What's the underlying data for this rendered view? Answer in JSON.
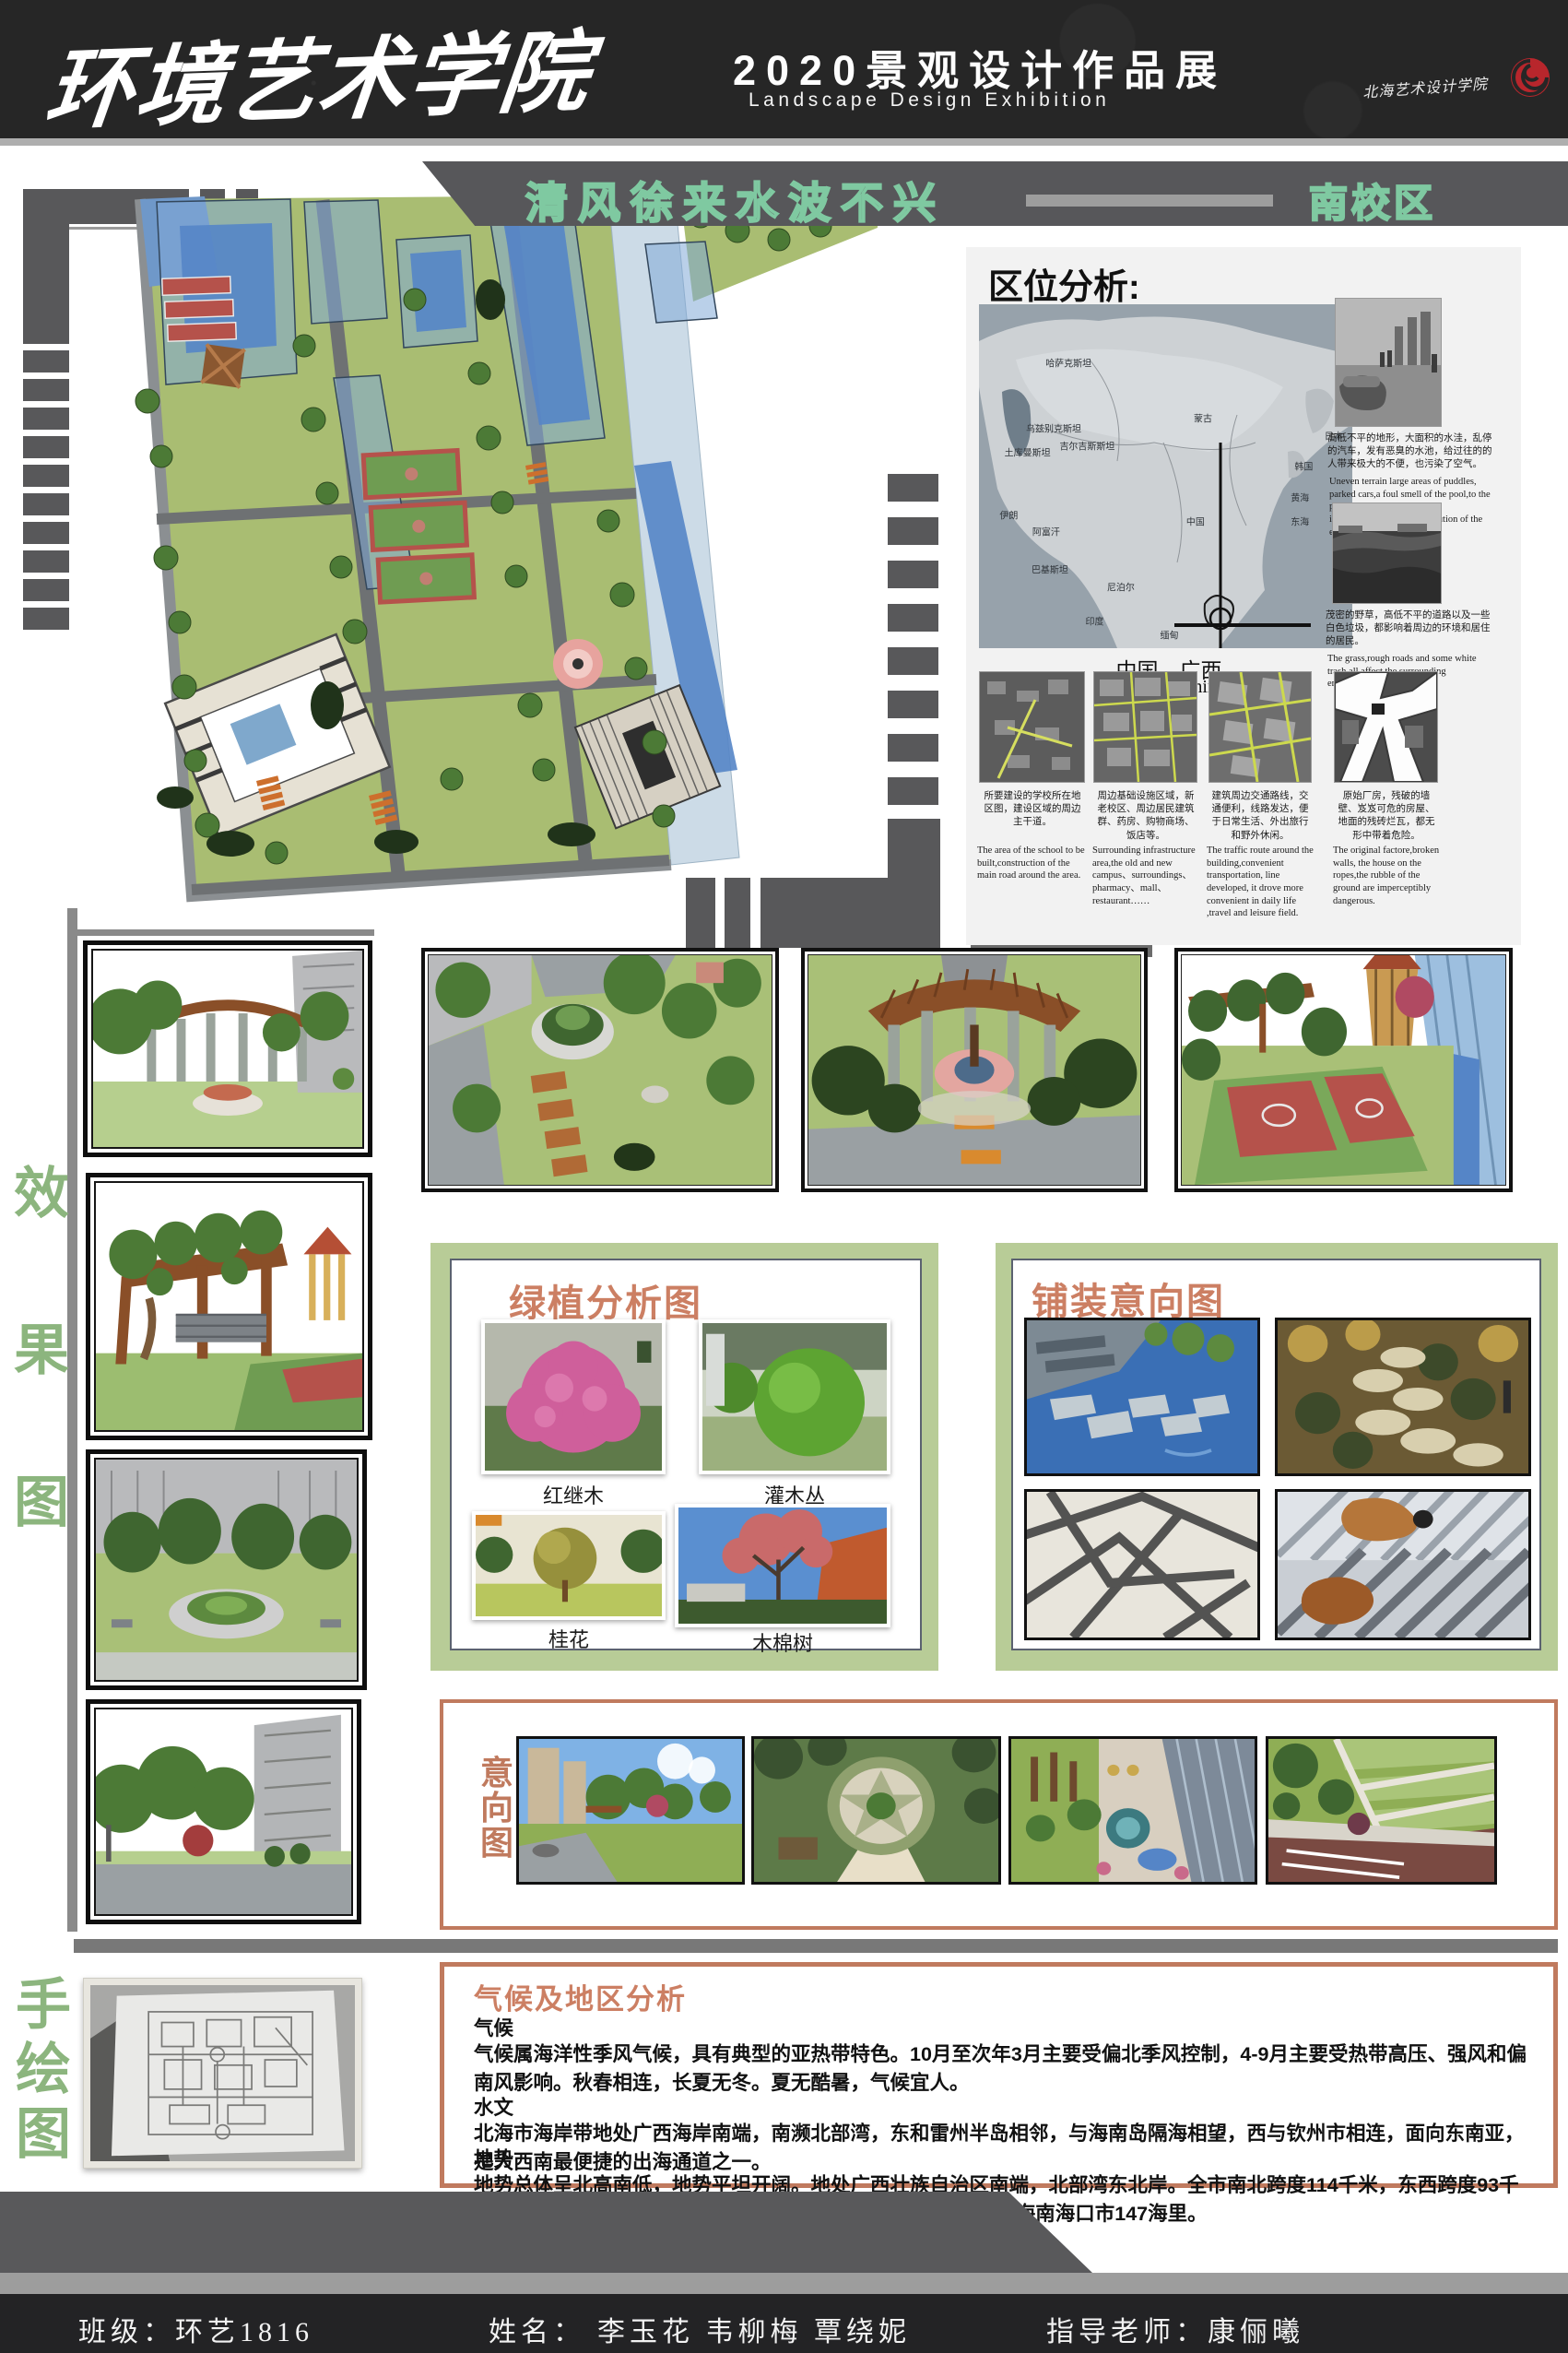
{
  "header": {
    "school": "环境艺术学院",
    "title": "2020景观设计作品展",
    "subtitle": "Landscape Design Exhibition",
    "logo_text": "北海艺术设计学院"
  },
  "banner": {
    "slogan": "清风徐来水波不兴",
    "campus": "南校区"
  },
  "location": {
    "title": "区位分析:",
    "map_labels": [
      {
        "t": "哈萨克斯坦",
        "x": 24,
        "y": 17
      },
      {
        "t": "乌兹别克斯坦",
        "x": 20,
        "y": 36
      },
      {
        "t": "土库曼斯坦",
        "x": 13,
        "y": 43
      },
      {
        "t": "吉尔吉斯斯坦",
        "x": 29,
        "y": 41
      },
      {
        "t": "蒙古",
        "x": 60,
        "y": 33
      },
      {
        "t": "伊朗",
        "x": 8,
        "y": 61
      },
      {
        "t": "阿富汗",
        "x": 18,
        "y": 66
      },
      {
        "t": "中国",
        "x": 58,
        "y": 63
      },
      {
        "t": "巴基斯坦",
        "x": 19,
        "y": 77
      },
      {
        "t": "尼泊尔",
        "x": 38,
        "y": 82
      },
      {
        "t": "印度",
        "x": 31,
        "y": 92
      },
      {
        "t": "缅甸",
        "x": 51,
        "y": 96
      },
      {
        "t": "日本",
        "x": 95,
        "y": 38
      },
      {
        "t": "韩国",
        "x": 87,
        "y": 47
      },
      {
        "t": "黄海",
        "x": 86,
        "y": 56
      },
      {
        "t": "东海",
        "x": 86,
        "y": 63
      }
    ],
    "map_caption_cn": "中国，广西",
    "map_caption_en": "Guangxi,China",
    "side_photos": [
      {
        "caption_cn": "高低不平的地形，大面积的水洼，乱停的汽车，发有恶臭的水池，给过往的的人带来极大的不便，也污染了空气。",
        "caption_en": "Uneven terrain large areas of puddles, parked cars,a foul smell of the pool,to the passing people bring great inconvenience, but also pollution of the environment."
      },
      {
        "caption_cn": "茂密的野草，高低不平的道路以及一些白色垃圾，都影响着周边的环境和居住的居民。",
        "caption_en": "The grass,rough roads and some white trash all affect the surrounding environment and residents."
      }
    ],
    "bottom_items": [
      {
        "caption_cn": "所要建设的学校所在地区图，建设区域的周边主干道。",
        "caption_en": "The area of the school to be built,construction of the main road around the area."
      },
      {
        "caption_cn": "周边基础设施区域，新老校区、周边居民建筑群、药房、购物商场、饭店等。",
        "caption_en": "Surrounding infrastructure area,the old and new campus、surroundings、pharmacy、mall、restaurant……"
      },
      {
        "caption_cn": "建筑周边交通路线，交通便利，线路发达，便于日常生活、外出旅行和野外休闲。",
        "caption_en": "The traffic route around the building,convenient transportation, line developed, it drove more convenient in daily life ,travel and leisure field."
      },
      {
        "caption_cn": "原始厂房，残破的墙壁、岌岌可危的房屋、地面的残砖烂瓦，都无形中带着危险。",
        "caption_en": "The original factore,broken walls, the house on the ropes,the rubble of the ground are imperceptibly dangerous."
      }
    ]
  },
  "left_labels": {
    "effect": [
      "效",
      "果",
      "图"
    ],
    "hand": [
      "手",
      "绘",
      "图"
    ]
  },
  "plants": {
    "title": "绿植分析图",
    "items": [
      {
        "name": "红继木"
      },
      {
        "name": "灌木丛"
      },
      {
        "name": "桂花"
      },
      {
        "name": "木棉树"
      }
    ]
  },
  "paving": {
    "title": "铺装意向图"
  },
  "intention": {
    "label": [
      "意",
      "向",
      "图"
    ]
  },
  "climate": {
    "title": "气候及地区分析",
    "paragraphs": [
      "气候",
      "气候属海洋性季风气候，具有典型的亚热带特色。10月至次年3月主要受偏北季风控制，4-9月主要受热带高压、强风和偏南风影响。秋春相连，长夏无冬。夏无酷暑，气候宜人。",
      "水文",
      "北海市海岸带地处广西海岸南端，南濒北部湾，东和雷州半岛相邻，与海南岛隔海相望，西与钦州市相连，面向东南亚，是大西南最便捷的出海通道之一。",
      "地势",
      "地势总体呈北高南低，地势平坦开阔。地处广西壮族自治区南端，北部湾东北岸。全市南北跨度114千米，东西跨度93千米。西北距首府南宁206公里，东距广东湛江198公里，东南距海南海口市147海里。"
    ]
  },
  "footer": {
    "class": "班级：环艺1816",
    "name_label": "姓名：",
    "names": "李玉花  韦柳梅  覃绕妮",
    "teacher": "指导老师：康俪曦"
  },
  "colors": {
    "accent_green": "#8cb57e",
    "frame_green": "#b8cc97",
    "accent_salmon": "#cc7f63",
    "banner_gray": "#57575a",
    "outline_green": "#7fc9a1"
  }
}
